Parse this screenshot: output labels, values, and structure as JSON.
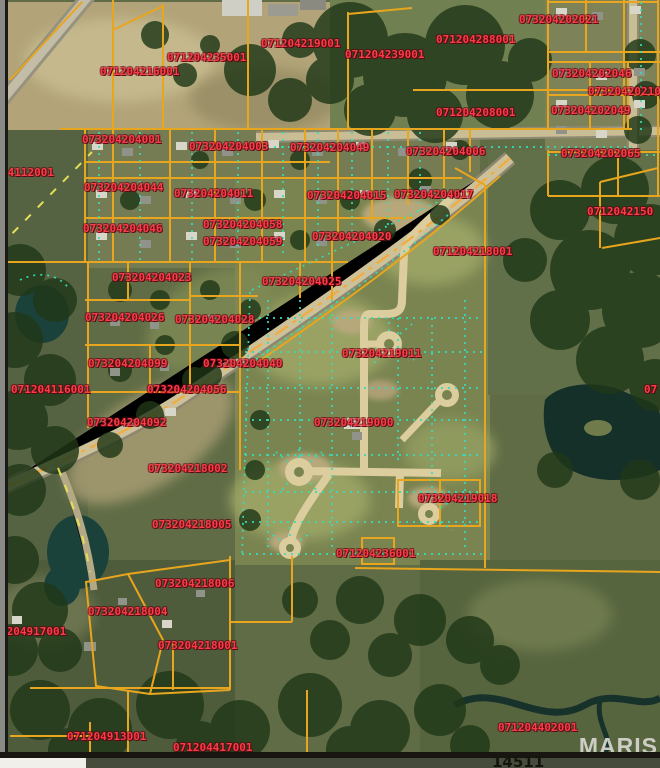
{
  "map": {
    "type": "aerial-parcel-map",
    "watermark": "MARIS",
    "note": "14511",
    "parcel_labels": [
      {
        "id": "071204216001",
        "x": 100,
        "y": 65
      },
      {
        "id": "071204235001",
        "x": 167,
        "y": 51
      },
      {
        "id": "071204219001",
        "x": 261,
        "y": 37
      },
      {
        "id": "071204288001",
        "x": 436,
        "y": 33
      },
      {
        "id": "071204239001",
        "x": 345,
        "y": 48
      },
      {
        "id": "073204202021",
        "x": 519,
        "y": 13
      },
      {
        "id": "073204202046",
        "x": 552,
        "y": 67
      },
      {
        "id": "07320420210",
        "x": 588,
        "y": 85
      },
      {
        "id": "073204202049",
        "x": 551,
        "y": 104
      },
      {
        "id": "071204208001",
        "x": 436,
        "y": 106
      },
      {
        "id": "073204202065",
        "x": 561,
        "y": 147
      },
      {
        "id": "073204204001",
        "x": 82,
        "y": 133
      },
      {
        "id": "073204204003",
        "x": 189,
        "y": 140
      },
      {
        "id": "073204204049",
        "x": 290,
        "y": 141
      },
      {
        "id": "073204204006",
        "x": 406,
        "y": 145
      },
      {
        "id": "04112001",
        "x": 1,
        "y": 166
      },
      {
        "id": "073204204044",
        "x": 84,
        "y": 181
      },
      {
        "id": "073204204011",
        "x": 174,
        "y": 187
      },
      {
        "id": "073204204015",
        "x": 307,
        "y": 189
      },
      {
        "id": "073204204017",
        "x": 394,
        "y": 188
      },
      {
        "id": "0712042150",
        "x": 587,
        "y": 205
      },
      {
        "id": "073204204046",
        "x": 83,
        "y": 222
      },
      {
        "id": "073204204058",
        "x": 203,
        "y": 218
      },
      {
        "id": "073204204059",
        "x": 203,
        "y": 235
      },
      {
        "id": "073204204020",
        "x": 312,
        "y": 230
      },
      {
        "id": "071204218001",
        "x": 433,
        "y": 245
      },
      {
        "id": "073204204023",
        "x": 112,
        "y": 271
      },
      {
        "id": "073204204025",
        "x": 262,
        "y": 275
      },
      {
        "id": "073204204026",
        "x": 85,
        "y": 311
      },
      {
        "id": "073204204028",
        "x": 175,
        "y": 313
      },
      {
        "id": "073204204099",
        "x": 88,
        "y": 357
      },
      {
        "id": "073204204040",
        "x": 203,
        "y": 357
      },
      {
        "id": "073204219011",
        "x": 342,
        "y": 347
      },
      {
        "id": "071204116001",
        "x": 11,
        "y": 383
      },
      {
        "id": "073204204056",
        "x": 147,
        "y": 383
      },
      {
        "id": "073204204092",
        "x": 87,
        "y": 416
      },
      {
        "id": "073204219000",
        "x": 314,
        "y": 416
      },
      {
        "id": "073204218002",
        "x": 148,
        "y": 462
      },
      {
        "id": "073204219018",
        "x": 418,
        "y": 492
      },
      {
        "id": "073204218005",
        "x": 152,
        "y": 518
      },
      {
        "id": "071204236001",
        "x": 336,
        "y": 547
      },
      {
        "id": "073204218006",
        "x": 155,
        "y": 577
      },
      {
        "id": "073204218004",
        "x": 88,
        "y": 605
      },
      {
        "id": "073204218001",
        "x": 158,
        "y": 639
      },
      {
        "id": "1204917001",
        "x": 0,
        "y": 625
      },
      {
        "id": "071204913001",
        "x": 67,
        "y": 730
      },
      {
        "id": "071204417001",
        "x": 173,
        "y": 741
      },
      {
        "id": "071204402001",
        "x": 498,
        "y": 721
      },
      {
        "id": "07",
        "x": 644,
        "y": 383
      }
    ]
  },
  "colors": {
    "parcel": "#e8a51e",
    "lot": "#35dcba",
    "label": "#fb3d47",
    "dash": "#e3df56",
    "roadline": "#f2ab3e",
    "watermark": "#d6d5d1"
  }
}
